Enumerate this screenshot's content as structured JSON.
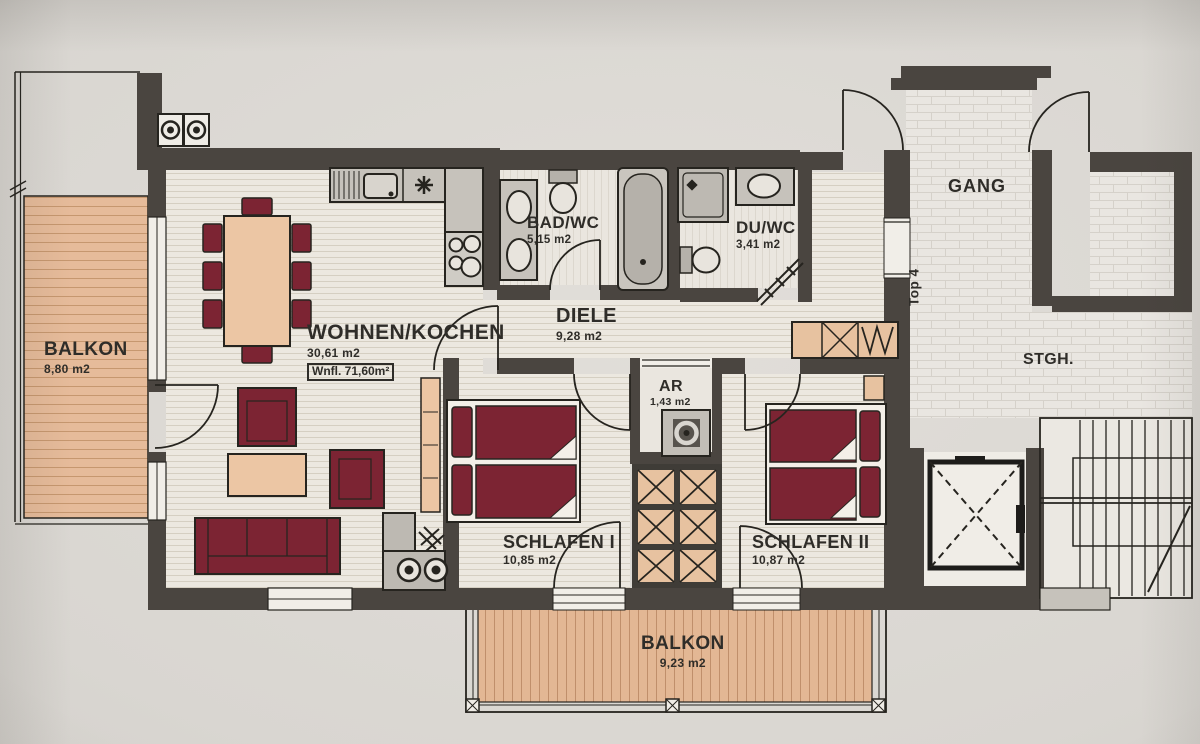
{
  "plan": {
    "unit": "Top 4",
    "living_area_box": "Wnfl. 71,60m²",
    "rooms": {
      "balkon_west": {
        "name": "BALKON",
        "area": "8,80 m2"
      },
      "wohnen_kochen": {
        "name": "WOHNEN/KOCHEN",
        "area": "30,61 m2"
      },
      "bad_wc": {
        "name": "BAD/WC",
        "area": "5,15 m2"
      },
      "du_wc": {
        "name": "DU/WC",
        "area": "3,41 m2"
      },
      "diele": {
        "name": "DIELE",
        "area": "9,28 m2"
      },
      "ar": {
        "name": "AR",
        "area": "1,43 m2"
      },
      "schlafen_1": {
        "name": "SCHLAFEN I",
        "area": "10,85 m2"
      },
      "schlafen_2": {
        "name": "SCHLAFEN II",
        "area": "10,87 m2"
      },
      "gang": {
        "name": "GANG"
      },
      "stiegenhaus": {
        "name": "STGH."
      },
      "balkon_sued": {
        "name": "BALKON",
        "area": "9,23 m2"
      }
    },
    "colors": {
      "wall": "#4a4540",
      "line": "#26241f",
      "furniture_red": "#7c2433",
      "wood_tan": "#e9c3a1",
      "balcony_deck": "#e4b795",
      "floor_light": "#ece8e0",
      "fixture_gray": "#c6c2bb",
      "paper": "#d9d6d1"
    }
  }
}
